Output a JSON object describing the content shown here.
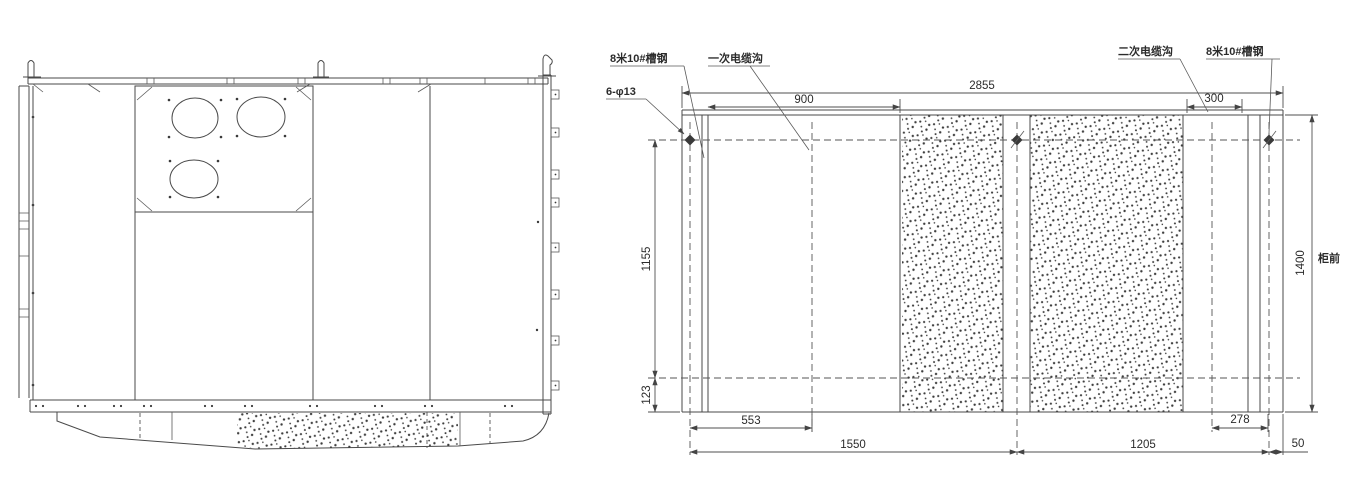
{
  "drawing": {
    "background": "#ffffff",
    "line_color": "#4a4a4a"
  },
  "plan": {
    "callouts": {
      "channel_left": "8米10#槽钢",
      "primary_trench": "一次电缆沟",
      "secondary_trench": "二次电缆沟",
      "channel_right": "8米10#槽钢",
      "holes": "6-φ13",
      "cabinet_front": "柜前"
    },
    "dimensions": {
      "total_width": "2855",
      "bay_left": "900",
      "bay_right": "300",
      "height_upper": "1155",
      "height_lower": "123",
      "depth": "1400",
      "trench_offset": "553",
      "span_left": "1550",
      "span_right": "1205",
      "offset_right": "278",
      "edge_margin": "50"
    }
  }
}
